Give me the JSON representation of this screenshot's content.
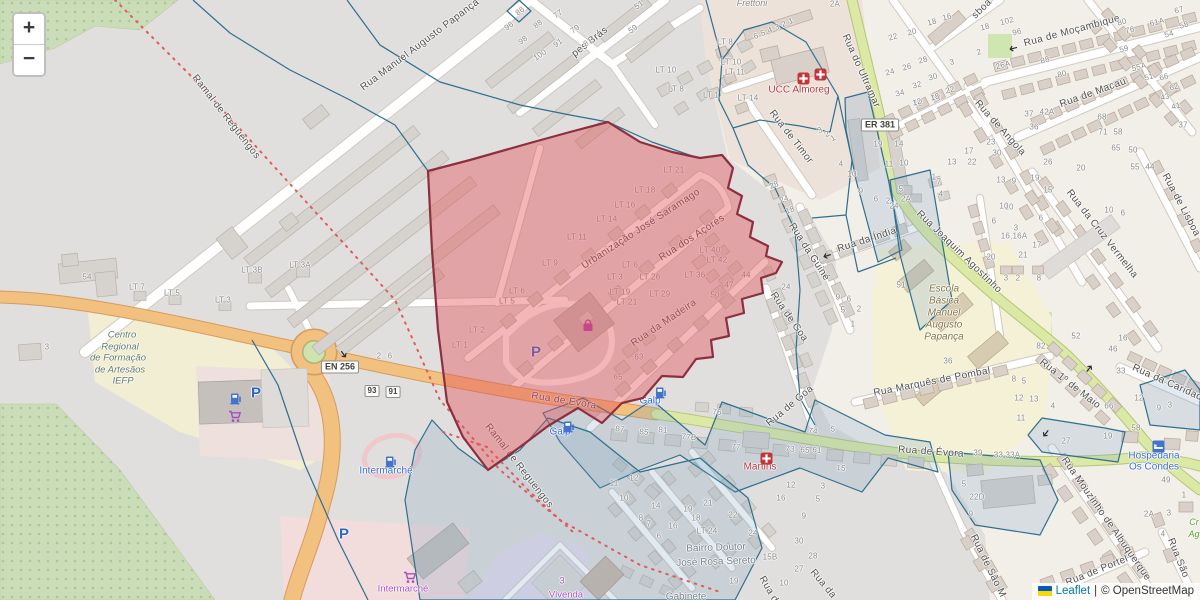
{
  "colors": {
    "highlight_fill": "#e35157",
    "highlight_border": "#8d2f3f",
    "boundary_blue": "#2e6f8e",
    "road_primary": "#f2c07f",
    "road_secondary": "#dce9a5",
    "poi_red": "#b5373c",
    "poi_blue": "#3a6fd8",
    "poi_purple": "#ae4fc0",
    "leaflet_link": "#0078a8"
  },
  "zoom_control": {
    "zoom_in": "+",
    "zoom_out": "−"
  },
  "attribution": {
    "leaflet_link": "Leaflet",
    "separator": "|",
    "osm_text": "© OpenStreetMap"
  },
  "shields": [
    {
      "text": "EN 256",
      "x": 340,
      "y": 367,
      "small": false
    },
    {
      "text": "ER 381",
      "x": 880,
      "y": 125,
      "small": false
    },
    {
      "text": "93",
      "x": 372,
      "y": 391,
      "small": true
    },
    {
      "text": "91",
      "x": 393,
      "y": 392,
      "small": true
    }
  ],
  "street_labels": [
    [
      "Rua Manuel Augusto Papança",
      420,
      45,
      -37
    ],
    [
      "pes Brás",
      590,
      42,
      -38
    ],
    [
      "Ramal de Reguengos",
      226,
      117,
      52
    ],
    [
      "Ramal de Reguengos",
      519,
      466,
      52
    ],
    [
      "Urbanização José Saramago",
      641,
      229,
      -33
    ],
    [
      "Rua dos Açores",
      692,
      238,
      -33
    ],
    [
      "Rua da Madeira",
      664,
      323,
      -34
    ],
    [
      "Rua de Évora",
      564,
      401,
      9
    ],
    [
      "Rua de Évora",
      931,
      452,
      4
    ],
    [
      "Rua de Timor",
      791,
      137,
      52
    ],
    [
      "Rua do Ultramar",
      861,
      71,
      66
    ],
    [
      "Rua da Guiné",
      809,
      252,
      57
    ],
    [
      "Rua de Goa",
      789,
      317,
      55
    ],
    [
      "Rua de Goa",
      790,
      406,
      -40
    ],
    [
      "Rua da Índia",
      867,
      240,
      -18
    ],
    [
      "Rua Joaquim Agostinho",
      959,
      252,
      44
    ],
    [
      "Rua de Moçambique",
      1072,
      31,
      -15
    ],
    [
      "Rua de Macau",
      1093,
      93,
      -20
    ],
    [
      "Rua de Angola",
      1000,
      128,
      48
    ],
    [
      "Rua da Cruz Vermelha",
      1102,
      234,
      52
    ],
    [
      "sboa",
      982,
      9,
      -45
    ],
    [
      "Rua de Lisboa",
      1181,
      205,
      62
    ],
    [
      "Rua 1º de Maio",
      1070,
      384,
      38
    ],
    [
      "Rua da Caridade",
      1170,
      384,
      24
    ],
    [
      "Rua Marquês de Pombal",
      932,
      382,
      -11
    ],
    [
      "Rua Mouzinho de Albuquerque",
      1106,
      519,
      55
    ],
    [
      "Rua de São M",
      988,
      566,
      64
    ],
    [
      "Rua de Portel",
      1097,
      571,
      -22
    ],
    [
      "Rua São",
      1178,
      558,
      68
    ],
    [
      "Rua de",
      770,
      592,
      60
    ],
    [
      "Rua da",
      823,
      584,
      50
    ]
  ],
  "place_labels": [
    [
      "Frettoni",
      752,
      3,
      "place-gray-italic",
      0
    ],
    [
      "UCC Almoreg",
      799,
      90,
      "poi-red",
      0
    ],
    [
      "Martins",
      760,
      467,
      "poi-red",
      0
    ],
    [
      "Galp",
      650,
      401,
      "poi-blue",
      0
    ],
    [
      "Galp",
      560,
      432,
      "poi-blue",
      0
    ],
    [
      "Intermarché",
      386,
      471,
      "poi-blue",
      0
    ],
    [
      "Intermarché",
      403,
      589,
      "poi-purple",
      0
    ],
    [
      "Hospedaria",
      1154,
      456,
      "poi-blue",
      0
    ],
    [
      "Os Condes",
      1154,
      467,
      "poi-blue",
      0
    ],
    [
      "3",
      562,
      581,
      "poi-purple",
      0
    ],
    [
      "Vivenda",
      566,
      595,
      "poi-purple",
      0
    ],
    [
      "Gabinete",
      686,
      597,
      "place-gray",
      0
    ],
    [
      "Bairro Doutor",
      716,
      548,
      "place-gray",
      -2
    ],
    [
      "José Rosa Sereto",
      716,
      562,
      "place-gray",
      -2
    ],
    [
      "Centro",
      122,
      335,
      "area-green",
      0
    ],
    [
      "Regional",
      120,
      347,
      "area-green",
      0
    ],
    [
      "de Formação",
      118,
      358,
      "area-green",
      0
    ],
    [
      "de Artesãos",
      120,
      370,
      "area-green",
      0
    ],
    [
      "IEFP",
      123,
      381,
      "area-green",
      0
    ],
    [
      "Escola",
      944,
      289,
      "area-school",
      0
    ],
    [
      "Básica",
      944,
      301,
      "area-school",
      0
    ],
    [
      "Manuel",
      944,
      313,
      "area-school",
      0
    ],
    [
      "Augusto",
      944,
      325,
      "area-school",
      0
    ],
    [
      "Papança",
      944,
      337,
      "area-school",
      0
    ],
    [
      "Cr",
      1194,
      522,
      "poi-green",
      0
    ],
    [
      "Ag",
      1194,
      534,
      "poi-green",
      0
    ]
  ],
  "house_numbers": [
    [
      "86",
      520,
      11,
      -35
    ],
    [
      "77",
      558,
      14,
      -35
    ],
    [
      "96",
      509,
      26,
      -35
    ],
    [
      "88",
      538,
      24,
      -35
    ],
    [
      "79",
      575,
      29,
      -35
    ],
    [
      "98",
      523,
      40,
      -35
    ],
    [
      "91",
      558,
      43,
      -35
    ],
    [
      "81",
      588,
      42,
      -35
    ],
    [
      "100",
      540,
      55,
      -35
    ],
    [
      "51",
      639,
      5,
      -35
    ],
    [
      "59",
      633,
      29,
      -35
    ],
    [
      "6",
      756,
      36,
      -20
    ],
    [
      "5",
      763,
      33,
      -20
    ],
    [
      "4",
      770,
      30,
      -20
    ],
    [
      "3",
      777,
      27,
      -20
    ],
    [
      "2",
      784,
      24,
      -20
    ],
    [
      "1",
      791,
      21,
      -20
    ],
    [
      "2A",
      835,
      4,
      0
    ],
    [
      "LT 8",
      725,
      42,
      0
    ],
    [
      "LT 10",
      666,
      70,
      0
    ],
    [
      "LT 8",
      676,
      89,
      0
    ],
    [
      "LT 1",
      711,
      95,
      0
    ],
    [
      "LT 10",
      731,
      62,
      0
    ],
    [
      "LT 11",
      735,
      72,
      0
    ],
    [
      "LT 14",
      748,
      98,
      0
    ],
    [
      "3",
      820,
      130,
      -30
    ],
    [
      "2",
      827,
      134,
      -30
    ],
    [
      "1",
      833,
      138,
      -30
    ],
    [
      "12",
      918,
      103,
      0
    ],
    [
      "18",
      936,
      98,
      0
    ],
    [
      "19",
      878,
      144,
      0
    ],
    [
      "14",
      899,
      144,
      0
    ],
    [
      "11",
      889,
      164,
      0
    ],
    [
      "10",
      904,
      163,
      0
    ],
    [
      "5",
      901,
      189,
      0
    ],
    [
      "2A",
      906,
      199,
      0
    ],
    [
      "4",
      841,
      164,
      0
    ],
    [
      "10",
      852,
      174,
      0
    ],
    [
      "9",
      861,
      191,
      0
    ],
    [
      "6",
      876,
      199,
      0
    ],
    [
      "2",
      888,
      201,
      0
    ],
    [
      "1",
      934,
      177,
      0
    ],
    [
      "7",
      939,
      182,
      0
    ],
    [
      "4",
      941,
      194,
      0
    ],
    [
      "13",
      952,
      162,
      0
    ],
    [
      "22",
      972,
      162,
      0
    ],
    [
      "17",
      969,
      151,
      0
    ],
    [
      "23",
      991,
      142,
      0
    ],
    [
      "30",
      997,
      153,
      0
    ],
    [
      "13",
      1001,
      180,
      0
    ],
    [
      "9",
      1014,
      181,
      0
    ],
    [
      "16",
      947,
      17,
      -15
    ],
    [
      "18",
      932,
      22,
      -15
    ],
    [
      "20",
      912,
      32,
      -15
    ],
    [
      "22",
      893,
      37,
      -15
    ],
    [
      "24",
      890,
      72,
      -15
    ],
    [
      "26",
      907,
      67,
      -15
    ],
    [
      "28",
      923,
      60,
      -15
    ],
    [
      "30",
      933,
      77,
      -15
    ],
    [
      "32",
      917,
      85,
      -15
    ],
    [
      "34",
      900,
      93,
      -15
    ],
    [
      "12",
      917,
      102,
      -15
    ],
    [
      "18",
      935,
      97,
      -15
    ],
    [
      "22",
      950,
      90,
      -15
    ],
    [
      "3",
      952,
      62,
      -15
    ],
    [
      "2",
      979,
      52,
      -15
    ],
    [
      "18",
      985,
      27,
      -15
    ],
    [
      "102",
      1007,
      21,
      -15
    ],
    [
      "96",
      1017,
      32,
      -15
    ],
    [
      "26A",
      1003,
      65,
      -15
    ],
    [
      "88",
      1045,
      60,
      -15
    ],
    [
      "80",
      1062,
      74,
      -15
    ],
    [
      "67",
      1179,
      10,
      -15
    ],
    [
      "80",
      1122,
      22,
      -15
    ],
    [
      "76",
      1130,
      30,
      -15
    ],
    [
      "61A",
      1157,
      22,
      -15
    ],
    [
      "58",
      1184,
      25,
      -15
    ],
    [
      "54",
      1169,
      34,
      -15
    ],
    [
      "59",
      1124,
      49,
      -15
    ],
    [
      "55A",
      1139,
      67,
      -15
    ],
    [
      "51",
      1149,
      77,
      -15
    ],
    [
      "66",
      1164,
      77,
      -15
    ],
    [
      "62",
      1174,
      87,
      -15
    ],
    [
      "43",
      1165,
      97,
      -15
    ],
    [
      "41",
      1176,
      106,
      -15
    ],
    [
      "37",
      1029,
      114,
      0
    ],
    [
      "42A",
      1047,
      112,
      0
    ],
    [
      "68",
      1102,
      117,
      0
    ],
    [
      "36",
      1034,
      127,
      0
    ],
    [
      "71",
      1103,
      132,
      0
    ],
    [
      "58",
      1118,
      132,
      0
    ],
    [
      "65",
      1116,
      148,
      0
    ],
    [
      "50",
      1133,
      150,
      0
    ],
    [
      "55",
      1135,
      167,
      0
    ],
    [
      "44",
      1150,
      167,
      0
    ],
    [
      "37",
      1183,
      125,
      0
    ],
    [
      "26",
      1048,
      162,
      0
    ],
    [
      "20",
      1081,
      168,
      0
    ],
    [
      "19",
      1035,
      178,
      0
    ],
    [
      "15",
      1048,
      190,
      0
    ],
    [
      "10",
      1009,
      207,
      0
    ],
    [
      "6",
      1041,
      218,
      0
    ],
    [
      "3",
      1016,
      228,
      0
    ],
    [
      "16,16A",
      1014,
      236,
      0
    ],
    [
      "17",
      1037,
      245,
      0
    ],
    [
      "21",
      1023,
      255,
      0
    ],
    [
      "20",
      991,
      257,
      0
    ],
    [
      "10",
      1109,
      210,
      0
    ],
    [
      "6",
      1123,
      213,
      0
    ],
    [
      "10",
      1004,
      206,
      0
    ],
    [
      "6",
      994,
      221,
      0
    ],
    [
      "3",
      1006,
      278,
      0
    ],
    [
      "2",
      1018,
      278,
      0
    ],
    [
      "8",
      1039,
      278,
      0
    ],
    [
      "51",
      901,
      285,
      0
    ],
    [
      "36",
      948,
      361,
      0
    ],
    [
      "24",
      894,
      206,
      0
    ],
    [
      "LT 21",
      674,
      170,
      0
    ],
    [
      "LT 18",
      645,
      190,
      0
    ],
    [
      "LT 16",
      625,
      205,
      0
    ],
    [
      "LT 14",
      607,
      219,
      0
    ],
    [
      "LT 11",
      577,
      237,
      0
    ],
    [
      "LT 9",
      550,
      263,
      0
    ],
    [
      "LT 6",
      630,
      265,
      0
    ],
    [
      "LT 3",
      615,
      277,
      0
    ],
    [
      "LT 26",
      650,
      277,
      0
    ],
    [
      "LT 19",
      620,
      292,
      0
    ],
    [
      "LT 21",
      627,
      302,
      0
    ],
    [
      "LT 29",
      660,
      294,
      0
    ],
    [
      "LT 36",
      695,
      275,
      0
    ],
    [
      "LT 40",
      710,
      250,
      0
    ],
    [
      "LT 42",
      717,
      260,
      0
    ],
    [
      "44",
      746,
      275,
      0
    ],
    [
      "47",
      729,
      285,
      0
    ],
    [
      "50",
      715,
      295,
      0
    ],
    [
      "LT 6",
      517,
      291,
      0
    ],
    [
      "LT 5",
      507,
      301,
      0
    ],
    [
      "LT 2",
      477,
      330,
      0
    ],
    [
      "LT 1",
      460,
      345,
      0
    ],
    [
      "63",
      639,
      357,
      0
    ],
    [
      "65",
      618,
      377,
      0
    ],
    [
      "28",
      774,
      185,
      -20
    ],
    [
      "24",
      784,
      199,
      -20
    ],
    [
      "18",
      790,
      210,
      -20
    ],
    [
      "24",
      786,
      287,
      0
    ],
    [
      "9",
      838,
      297,
      0
    ],
    [
      "6",
      849,
      299,
      0
    ],
    [
      "5",
      843,
      310,
      0
    ],
    [
      "2",
      859,
      309,
      0
    ],
    [
      "1",
      853,
      324,
      0
    ],
    [
      "54",
      87,
      277,
      0
    ],
    [
      "LT 7",
      137,
      287,
      0
    ],
    [
      "LT 5",
      172,
      293,
      0
    ],
    [
      "LT 3",
      223,
      300,
      0
    ],
    [
      "LT 3B",
      252,
      270,
      0
    ],
    [
      "LT 3A",
      300,
      265,
      0
    ],
    [
      "3",
      47,
      347,
      0
    ],
    [
      "2",
      379,
      356,
      0
    ],
    [
      "6",
      390,
      356,
      0
    ],
    [
      "87",
      620,
      429,
      6
    ],
    [
      "85",
      644,
      432,
      6
    ],
    [
      "81",
      663,
      430,
      6
    ],
    [
      "77B",
      689,
      437,
      6
    ],
    [
      "77",
      736,
      447,
      6
    ],
    [
      "76",
      717,
      412,
      6
    ],
    [
      "73",
      790,
      449,
      6
    ],
    [
      "65",
      805,
      450,
      6
    ],
    [
      "61",
      817,
      450,
      6
    ],
    [
      "74",
      813,
      431,
      6
    ],
    [
      "5",
      833,
      429,
      6
    ],
    [
      "15",
      841,
      468,
      6
    ],
    [
      "12",
      791,
      485,
      0
    ],
    [
      "3",
      823,
      486,
      0
    ],
    [
      "11",
      614,
      483,
      0
    ],
    [
      "12",
      634,
      478,
      0
    ],
    [
      "52",
      1076,
      336,
      0
    ],
    [
      "82",
      1041,
      346,
      0
    ],
    [
      "16",
      1123,
      338,
      0
    ],
    [
      "46",
      1113,
      349,
      0
    ],
    [
      "33",
      1121,
      371,
      0
    ],
    [
      "12",
      1139,
      398,
      0
    ],
    [
      "9",
      1159,
      408,
      0
    ],
    [
      "3",
      1170,
      405,
      0
    ],
    [
      "8",
      1014,
      379,
      0
    ],
    [
      "5",
      1024,
      381,
      0
    ],
    [
      "12",
      1019,
      398,
      0
    ],
    [
      "13",
      1034,
      399,
      0
    ],
    [
      "4",
      1053,
      406,
      0
    ],
    [
      "11",
      1021,
      418,
      0
    ],
    [
      "66",
      1109,
      406,
      0
    ],
    [
      "58",
      1136,
      428,
      0
    ],
    [
      "27",
      1066,
      441,
      0
    ],
    [
      "19",
      1108,
      436,
      0
    ],
    [
      "49",
      1166,
      480,
      0
    ],
    [
      "9",
      971,
      514,
      0
    ],
    [
      "22D",
      977,
      497,
      0
    ],
    [
      "5",
      964,
      484,
      0
    ],
    [
      "39",
      978,
      453,
      0
    ],
    [
      "33,33A",
      1007,
      455,
      0
    ],
    [
      "2A",
      1149,
      514,
      0
    ],
    [
      "3",
      1169,
      513,
      0
    ],
    [
      "4",
      1163,
      534,
      0
    ],
    [
      "1",
      1184,
      495,
      0
    ],
    [
      "10",
      624,
      498,
      0
    ],
    [
      "14",
      656,
      506,
      0
    ],
    [
      "19",
      688,
      509,
      0
    ],
    [
      "21",
      708,
      503,
      0
    ],
    [
      "22",
      733,
      515,
      0
    ],
    [
      "18",
      696,
      518,
      0
    ],
    [
      "16",
      673,
      526,
      0
    ],
    [
      "8",
      641,
      518,
      0
    ],
    [
      "7",
      649,
      524,
      0
    ],
    [
      "6",
      659,
      536,
      0
    ],
    [
      "LT 24",
      707,
      531,
      0
    ],
    [
      "24",
      753,
      533,
      0
    ],
    [
      "15B",
      770,
      557,
      0
    ],
    [
      "30",
      799,
      541,
      0
    ],
    [
      "28",
      813,
      556,
      0
    ],
    [
      "27",
      799,
      569,
      0
    ],
    [
      "16",
      781,
      498,
      0
    ],
    [
      "5",
      818,
      499,
      0
    ],
    [
      "9",
      804,
      516,
      0
    ],
    [
      "19",
      734,
      581,
      0
    ],
    [
      "10",
      784,
      583,
      0
    ]
  ],
  "icons": [
    [
      "fuel-icon",
      655,
      385,
      0
    ],
    [
      "fuel-icon",
      563,
      419,
      0
    ],
    [
      "fuel-icon",
      385,
      454,
      0
    ],
    [
      "fuel-icon",
      230,
      391,
      0
    ],
    [
      "parking-icon",
      256,
      393,
      0,
      "P"
    ],
    [
      "parking-icon",
      536,
      352,
      0,
      "P"
    ],
    [
      "parking-icon",
      344,
      534,
      0,
      "P"
    ],
    [
      "shopping-cart-icon",
      228,
      410,
      0
    ],
    [
      "shopping-cart-icon",
      403,
      571,
      0
    ],
    [
      "shopping-bag-icon",
      581,
      318,
      0
    ],
    [
      "medical-cross-icon",
      797,
      72,
      0
    ],
    [
      "medical-cross-icon",
      814,
      68,
      0
    ],
    [
      "medical-cross-icon",
      760,
      452,
      0
    ],
    [
      "lodging-icon",
      1152,
      440,
      0
    ],
    [
      "oneway-arrow-icon",
      1019,
      51,
      165
    ],
    [
      "oneway-arrow-icon",
      833,
      258,
      162
    ],
    [
      "oneway-arrow-icon",
      1083,
      370,
      -52
    ],
    [
      "oneway-arrow-icon",
      1052,
      432,
      128
    ],
    [
      "oneway-arrow-icon",
      344,
      348,
      55
    ]
  ]
}
